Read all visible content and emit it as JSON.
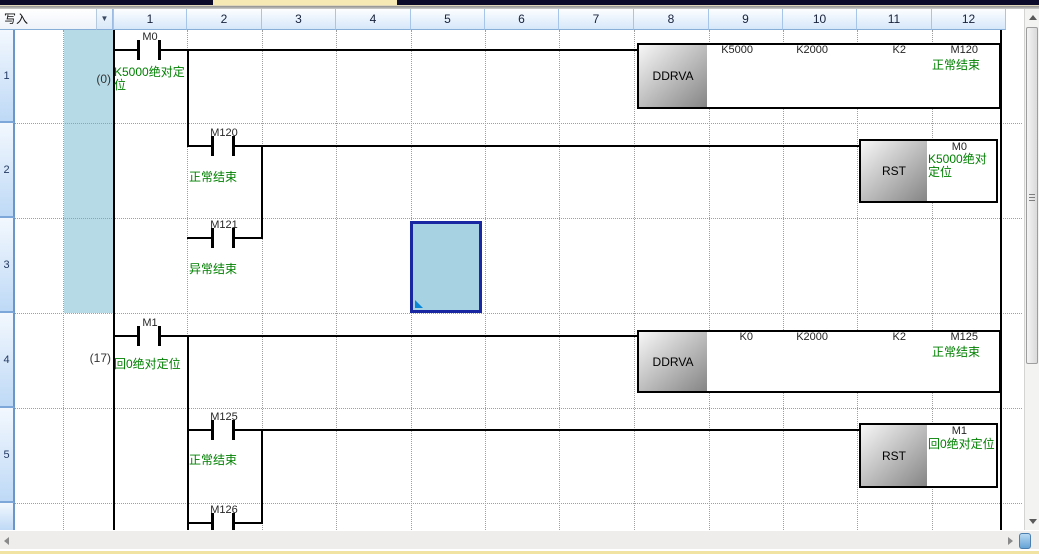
{
  "header": {
    "write_label": "写入",
    "dropdown_icon": "▼",
    "columns": [
      "1",
      "2",
      "3",
      "4",
      "5",
      "6",
      "7",
      "8",
      "9",
      "10",
      "11",
      "12"
    ]
  },
  "row_numbers": [
    "1",
    "2",
    "3",
    "4",
    "5"
  ],
  "ladder": {
    "steps": [
      "(0)",
      "(17)"
    ],
    "contacts": [
      {
        "device": "M0",
        "comment": "K5000绝对定位"
      },
      {
        "device": "M120",
        "comment": "正常结束"
      },
      {
        "device": "M121",
        "comment": "异常结束"
      },
      {
        "device": "M1",
        "comment": "回0绝对定位"
      },
      {
        "device": "M125",
        "comment": "正常结束"
      },
      {
        "device": "M126",
        "comment": ""
      }
    ],
    "instructions": [
      {
        "name": "DDRVA",
        "params": [
          "K5000",
          "K2000",
          "K2",
          "M120"
        ],
        "result_comment": "正常结束"
      },
      {
        "name": "RST",
        "operand": "M0",
        "operand_comment": "K5000绝对定位"
      },
      {
        "name": "DDRVA",
        "params": [
          "K0",
          "K2000",
          "K2",
          "M125"
        ],
        "result_comment": "正常结束"
      },
      {
        "name": "RST",
        "operand": "M1",
        "operand_comment": "回0绝对定位"
      }
    ]
  },
  "colors": {
    "comment_green": "#008000",
    "selection_fill": "#a7d2e2",
    "selection_border": "#1927a3",
    "statement_band": "#b6dbe7",
    "header_gradient_bottom": "#d6e7fa",
    "block_gray": "#858585"
  }
}
